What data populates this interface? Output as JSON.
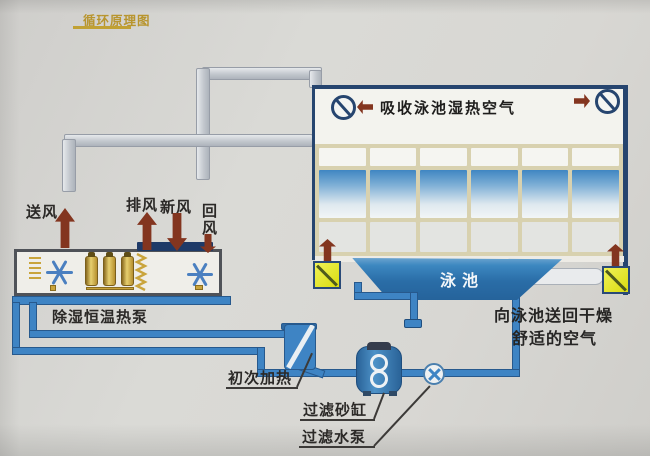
{
  "title": {
    "text": "循环原理图"
  },
  "pool_room": {
    "banner": "吸收泳池湿热空气",
    "pool_label": "泳池",
    "glass_wall": {
      "rows": 3,
      "cols": 6
    }
  },
  "air_labels": {
    "supply": "送风",
    "exhaust": "排风",
    "fresh": "新风",
    "return": "回风"
  },
  "equipment": {
    "heat_pump": "除湿恒温热泵",
    "initial_heating": "初次加热",
    "sand_filter": "过滤砂缸",
    "filter_pump": "过滤水泵"
  },
  "annotations": {
    "send_back_line1": "向泳池送回干燥",
    "send_back_line2": "舒适的空气"
  },
  "icons": {
    "damper_fan": "circle-with-diagonal-slash",
    "unit_fan": "six-spoke-blue-star",
    "flow_arrow": "solid-dark-red-arrow",
    "supply_grille": "yellow-box-with-diagonal",
    "pump": "circle-with-cross-blades"
  },
  "colors": {
    "pipe_blue": "#3e84c4",
    "pool_blue": "#2a6da7",
    "duct_gray": "#c3c8ce",
    "arrow_red": "#83351f",
    "grille_yellow": "#e0e21d",
    "title_gold": "#b8952e",
    "outline_navy": "#26456f",
    "compressor_gold": "#c9a43c",
    "background": "#d6d5d1"
  }
}
